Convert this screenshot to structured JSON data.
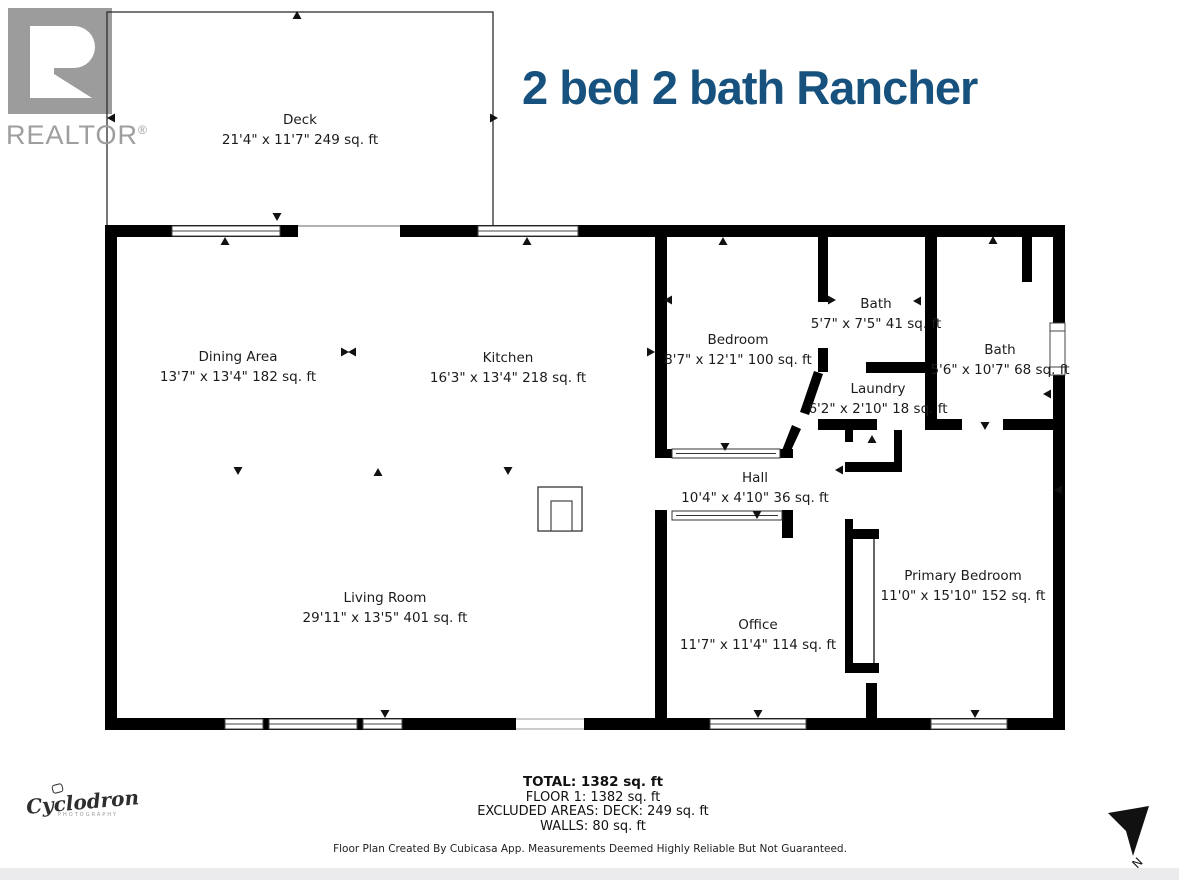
{
  "header": {
    "title": "2 bed 2 bath Rancher",
    "title_color": "#17517e"
  },
  "branding": {
    "realtor_name": "REALTOR",
    "realtor_reg": "®",
    "photographer_name": "Cyclodron",
    "photographer_subtitle": "PHOTOGRAPHY"
  },
  "compass": {
    "north_label": "N"
  },
  "floor_plan": {
    "rooms": [
      {
        "id": "deck",
        "name": "Deck",
        "dims": "21'4\" x 11'7\" 249 sq. ft",
        "cx": 300,
        "cy": 130
      },
      {
        "id": "dining-area",
        "name": "Dining Area",
        "dims": "13'7\" x 13'4\" 182 sq. ft",
        "cx": 238,
        "cy": 367
      },
      {
        "id": "kitchen",
        "name": "Kitchen",
        "dims": "16'3\" x 13'4\" 218 sq. ft",
        "cx": 508,
        "cy": 368
      },
      {
        "id": "bedroom",
        "name": "Bedroom",
        "dims": "8'7\" x 12'1\" 100 sq. ft",
        "cx": 738,
        "cy": 350
      },
      {
        "id": "bath-1",
        "name": "Bath",
        "dims": "5'7\" x 7'5\" 41 sq. ft",
        "cx": 876,
        "cy": 314
      },
      {
        "id": "bath-2",
        "name": "Bath",
        "dims": "5'6\" x 10'7\" 68 sq. ft",
        "cx": 1000,
        "cy": 360
      },
      {
        "id": "laundry",
        "name": "Laundry",
        "dims": "6'2\" x 2'10\" 18 sq. ft",
        "cx": 878,
        "cy": 399
      },
      {
        "id": "hall",
        "name": "Hall",
        "dims": "10'4\" x 4'10\" 36 sq. ft",
        "cx": 755,
        "cy": 488
      },
      {
        "id": "living-room",
        "name": "Living Room",
        "dims": "29'11\" x 13'5\" 401 sq. ft",
        "cx": 385,
        "cy": 608
      },
      {
        "id": "office",
        "name": "Office",
        "dims": "11'7\" x 11'4\" 114 sq. ft",
        "cx": 758,
        "cy": 635
      },
      {
        "id": "primary-bedroom",
        "name": "Primary Bedroom",
        "dims": "11'0\" x 15'10\" 152 sq. ft",
        "cx": 963,
        "cy": 586
      }
    ],
    "summary": {
      "total": "TOTAL: 1382 sq. ft",
      "floor": "FLOOR 1: 1382 sq. ft",
      "excluded": "EXCLUDED AREAS: DECK: 249 sq. ft",
      "walls": "WALLS: 80 sq. ft"
    },
    "disclaimer": "Floor Plan Created By Cubicasa App. Measurements Deemed Highly Reliable But Not Guaranteed."
  },
  "colors": {
    "wall": "#000000",
    "logo_gray": "#9c9c9c",
    "band_gray": "#ebebed"
  }
}
